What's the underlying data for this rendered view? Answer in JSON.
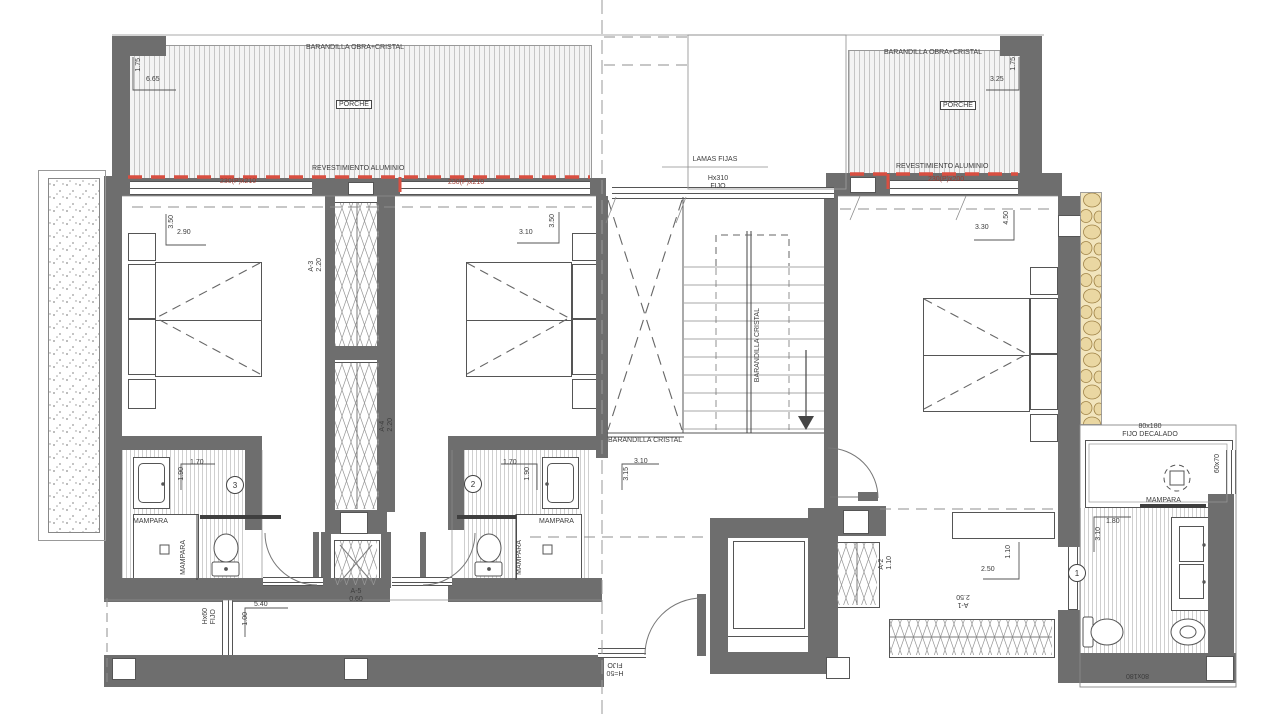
{
  "colors": {
    "wall": "#6e6e6e",
    "red_dash": "#d94f41",
    "stone": "#eadbb0"
  },
  "porch_left": {
    "railing_label": "BARANDILLA OBRA+CRISTAL",
    "room_label": "PORCHE",
    "cladding_label": "REVESTIMIENTO ALUMINIO",
    "door_label_1": "230(P)x210",
    "door_label_2": "230(P)x210",
    "dim_depth": "1.75",
    "dim_width": "6.65"
  },
  "porch_right": {
    "railing_label": "BARANDILLA OBRA+CRISTAL",
    "room_label": "PORCHE",
    "cladding_label": "REVESTIMIENTO ALUMINIO",
    "door_label": "230(P)x200",
    "dim_width": "3.25",
    "dim_depth": "1.75"
  },
  "top_center": {
    "louvers_label": "LAMAS FIJAS",
    "window_height": "Hx310",
    "window_type": "FIJO"
  },
  "bedroom_left": {
    "dim_depth": "3.50",
    "dim_width": "2.90"
  },
  "bedroom_center": {
    "dim_depth": "3.50",
    "dim_width": "3.10"
  },
  "bedroom_right": {
    "dim_width": "3.30",
    "dim_depth": "4.50"
  },
  "closet_a3": {
    "code": "A-3",
    "size": "2.20"
  },
  "closet_a4": {
    "code": "A-4",
    "size": "2.20"
  },
  "closet_a5": {
    "code": "A-5",
    "size": "0.60"
  },
  "closet_a2": {
    "code": "A-2",
    "size": "1.10"
  },
  "closet_a1": {
    "code": "A-1",
    "size": "2.50"
  },
  "stairwell": {
    "void_railing_label": "BARANDILLA CRISTAL",
    "stair_railing_label": "BARANDILLA CRISTAL",
    "landing_dim_depth": "3.15",
    "landing_dim_width": "3.10"
  },
  "bath_3": {
    "number": "3",
    "dim_width": "1.70",
    "dim_depth": "1.90",
    "screen_label": "MAMPARA",
    "screen_label_side": "MAMPARA"
  },
  "bath_2": {
    "number": "2",
    "dim_width": "1.70",
    "dim_depth": "1.90",
    "screen_label": "MAMPARA",
    "screen_label_side": "MAMPARA"
  },
  "bath_1": {
    "number": "1",
    "shower_window_size": "80x180",
    "shower_window_type": "FIJO DECALADO",
    "side_window_size": "60x70",
    "screen_label": "MAMPARA",
    "dim_width": "1.80",
    "dim_depth": "3.10",
    "bottom_window_size": "80x180"
  },
  "dressing": {
    "dim_width": "2.50",
    "dim_depth": "1.10"
  },
  "terrace": {
    "side_window_height": "Hx60",
    "side_window_type": "FIJO",
    "dim_width": "5.40",
    "dim_depth": "1.00"
  },
  "entry": {
    "sill_window_height": "H=50",
    "sill_window_type": "FIJO"
  }
}
